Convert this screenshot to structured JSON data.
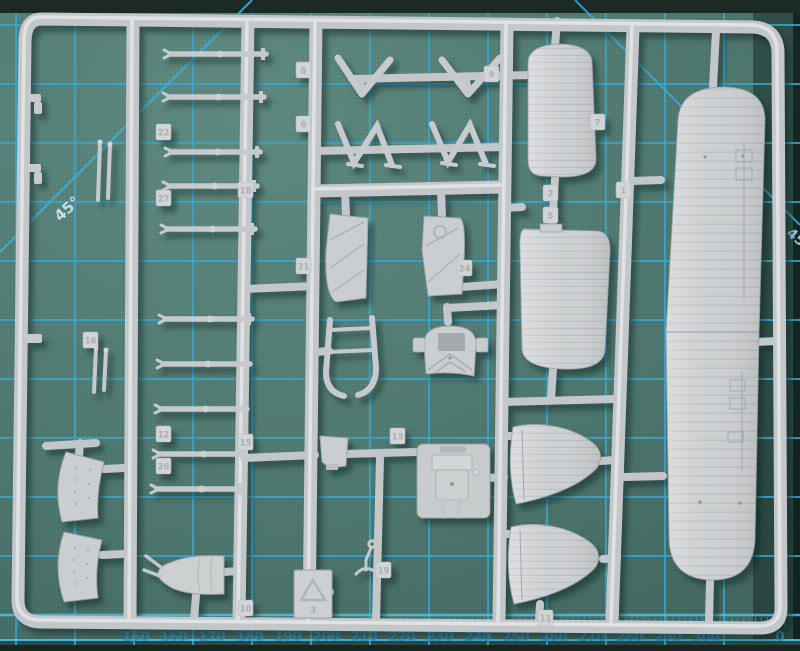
{
  "scene": {
    "description": "Photograph of a light-grey injection-moulded model aircraft sprue (runner with wings, floats, struts, cowl and engine parts) lying on a green self-healing cutting mat with cyan grid lines",
    "type": "photograph"
  },
  "mat": {
    "surface_color": "#4e7a71",
    "grid_color": "#38a6d0",
    "grid_bright_color": "#4fc2ea",
    "edge_band_color": "#1b2a24",
    "angle_label_topleft": "45°",
    "angle_label_right": "45",
    "grid": {
      "x_start": 16,
      "x_step": 59,
      "x_count": 13,
      "y_start": 25,
      "y_step": 59,
      "y_count": 11
    },
    "ticks": {
      "x0": 18,
      "x1": 786,
      "step": 5.9,
      "y0": 617,
      "y1": 627
    },
    "scale_numbers": [
      "150",
      "160",
      "170",
      "180",
      "190",
      "200",
      "210",
      "220",
      "230",
      "240",
      "250",
      "260",
      "270",
      "280",
      "290",
      "300",
      "0"
    ],
    "scale_positions_x": [
      136,
      174,
      212,
      250,
      288,
      326,
      364,
      402,
      440,
      478,
      516,
      554,
      592,
      630,
      668,
      706,
      780
    ],
    "scale_number_color": "#2f93c5"
  },
  "sprue": {
    "plastic_color": "#c6cacc",
    "plastic_highlight": "#e3e6e7",
    "plastic_shadow": "#9aa1a4",
    "material_mark": "3",
    "parts": [
      "upper-wing-panel-pair",
      "float-half-a",
      "float-half-b",
      "stabilizer-fin-a",
      "stabilizer-fin-b",
      "cowl-band-a",
      "cowl-band-b",
      "nose-cowl-cone",
      "engine-block-assembly",
      "radiator-front-frame",
      "float-support-u-frame",
      "fuselage-side-panel-a",
      "fuselage-side-panel-b",
      "v-strut-pair-a",
      "v-strut-pair-b",
      "w-strut-assembly-a",
      "w-strut-assembly-b",
      "spreader-bar",
      "wing-struts",
      "rigging-pins",
      "small-clips",
      "tail-skid",
      "material-tag"
    ],
    "part_tags": [
      {
        "label": "8",
        "x": 296,
        "y": 62
      },
      {
        "label": "9",
        "x": 484,
        "y": 66
      },
      {
        "label": "6",
        "x": 296,
        "y": 116
      },
      {
        "label": "7",
        "x": 590,
        "y": 114
      },
      {
        "label": "22",
        "x": 156,
        "y": 124
      },
      {
        "label": "27",
        "x": 156,
        "y": 190
      },
      {
        "label": "18",
        "x": 238,
        "y": 182
      },
      {
        "label": "2",
        "x": 543,
        "y": 185
      },
      {
        "label": "5",
        "x": 543,
        "y": 207
      },
      {
        "label": "1",
        "x": 616,
        "y": 182
      },
      {
        "label": "21",
        "x": 296,
        "y": 258
      },
      {
        "label": "24",
        "x": 457,
        "y": 260
      },
      {
        "label": "16",
        "x": 83,
        "y": 332
      },
      {
        "label": "12",
        "x": 156,
        "y": 426
      },
      {
        "label": "15",
        "x": 238,
        "y": 434
      },
      {
        "label": "26",
        "x": 156,
        "y": 458
      },
      {
        "label": "13",
        "x": 390,
        "y": 428
      },
      {
        "label": "19",
        "x": 376,
        "y": 562
      },
      {
        "label": "10",
        "x": 238,
        "y": 600
      },
      {
        "label": "11",
        "x": 538,
        "y": 610
      }
    ],
    "struts": [
      [
        164,
        266,
        54
      ],
      [
        163,
        264,
        97
      ],
      [
        165,
        260,
        152
      ],
      [
        163,
        257,
        186
      ],
      [
        161,
        255,
        229
      ],
      [
        159,
        252,
        319
      ],
      [
        157,
        250,
        364
      ],
      [
        155,
        247,
        409
      ],
      [
        153,
        245,
        454
      ],
      [
        151,
        243,
        489
      ]
    ],
    "pins": [
      [
        100,
        142,
        98,
        200
      ],
      [
        110,
        144,
        108,
        198
      ],
      [
        96,
        348,
        94,
        392
      ],
      [
        106,
        350,
        104,
        390
      ]
    ]
  }
}
